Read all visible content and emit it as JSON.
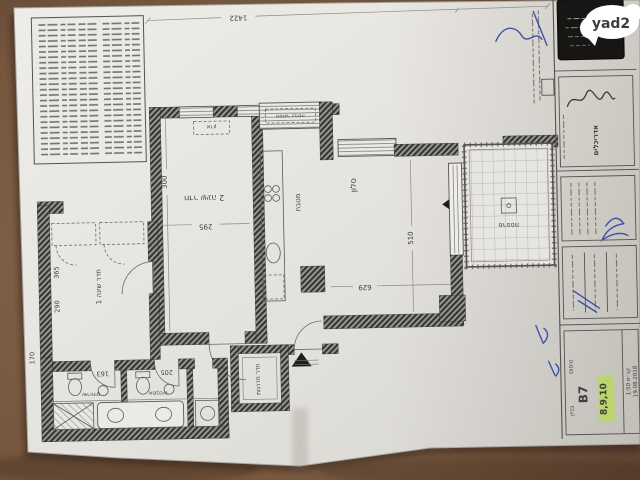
{
  "overlay": {
    "logo_text": "yad2"
  },
  "colors": {
    "table": "#77583f",
    "paper": "#e6e4df",
    "wall": "#3f3f3f",
    "stamp": "#171615",
    "highlight": "#b9d763",
    "pen": "#3d52a5",
    "logo_bg": "#ffffff",
    "logo_text": "#1c1c1c"
  },
  "plan": {
    "labels": {
      "bedroom2": "חדר שינה 2",
      "bedroom1": "חדר שינה 1",
      "kitchen": "מטבח",
      "living": "סלון",
      "balcony": "מרפסת",
      "laundry": "מסתור כביסה",
      "closet": "ארון",
      "wc": "שירותים",
      "bath": "אמבטיה",
      "stairs": "חדר מדרגות"
    },
    "dims": {
      "top": "1422",
      "bedroom2_w": "295",
      "bedroom2_h": "300",
      "bedroom1_w": "290",
      "bedroom1_h": "365",
      "corridor": "170",
      "wc": "163",
      "bath": "205",
      "living_h": "510",
      "living_w": "629"
    }
  },
  "title_block": {
    "firm": "אדריכלים",
    "building_label": "בניין",
    "building_value": "B7",
    "type_label": "טיפוס",
    "units_value": "8,9,10",
    "scale_value": "קנ״מ 1:50",
    "date_value": "19.08.2018"
  }
}
